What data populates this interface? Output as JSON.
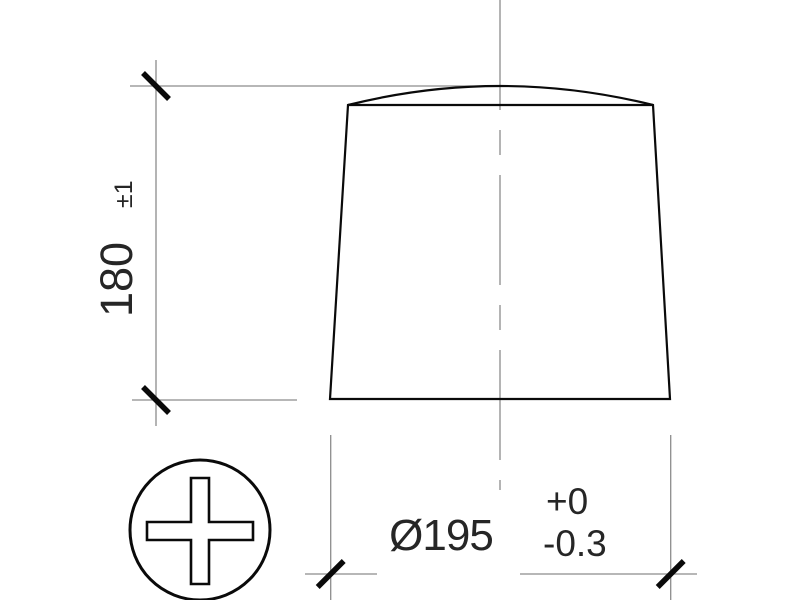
{
  "drawing": {
    "kind": "technical-dimension-drawing",
    "subject": "tapered cylindrical body with domed top, side view",
    "height_dimension": {
      "value": "180",
      "tolerance": "±1"
    },
    "diameter_dimension": {
      "value": "Ø195",
      "tolerance_upper": "+0",
      "tolerance_lower": "-0.3"
    },
    "symbol": {
      "name": "positive-polarity-plus-in-circle"
    },
    "colors": {
      "background": "#ffffff",
      "thin_line": "#8c8c8c",
      "outline": "#0a0a0a",
      "text": "#262626"
    }
  }
}
